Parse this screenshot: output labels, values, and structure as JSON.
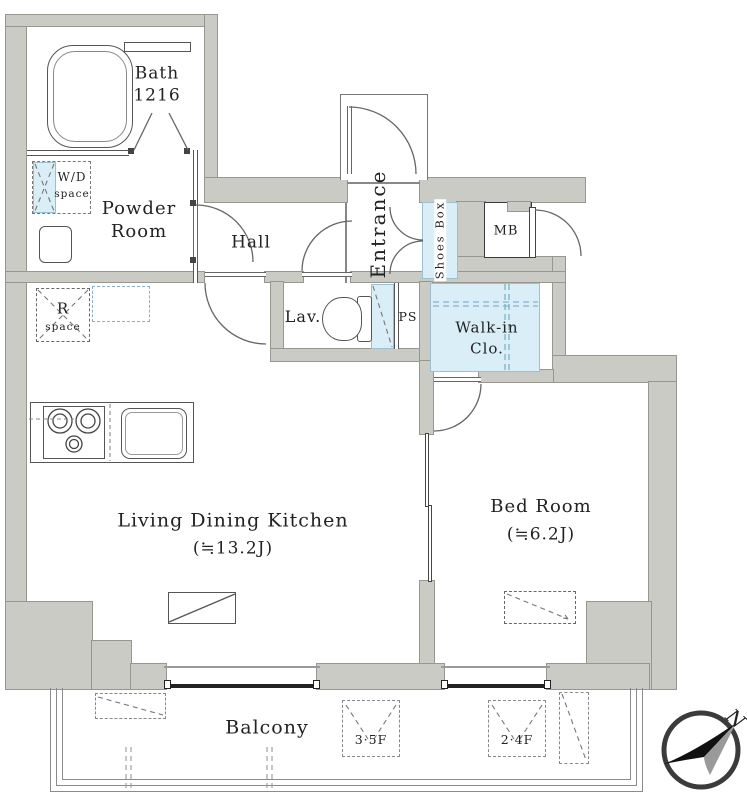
{
  "title": "apartment-floor-plan",
  "colors": {
    "wall_fill": "#cbcbc5",
    "wall_edge": "#97978f",
    "fixture_blue": "#d9eef7",
    "line": "#555555"
  },
  "rooms": {
    "bath": {
      "name": "Bath",
      "size": "1216"
    },
    "wd": {
      "line1": "W/D",
      "line2": "space"
    },
    "powder": {
      "line1": "Powder",
      "line2": "Room"
    },
    "hall": {
      "name": "Hall"
    },
    "entrance": {
      "name": "Entrance"
    },
    "shoes": {
      "name": "Shoes Box"
    },
    "mb": {
      "name": "MB"
    },
    "lav": {
      "name": "Lav."
    },
    "ps": {
      "name": "PS"
    },
    "wic": {
      "line1": "Walk-in",
      "line2": "Clo."
    },
    "rspace": {
      "line1": "R",
      "line2": "space"
    },
    "ldk": {
      "name": "Living Dining Kitchen",
      "size": "(≒13.2J)"
    },
    "bedroom": {
      "name": "Bed Room",
      "size": "(≒6.2J)"
    },
    "balcony": {
      "name": "Balcony"
    }
  },
  "annotations": {
    "ac_floor_high": "3·5F",
    "ac_floor_low": "2·4F",
    "north": "N"
  }
}
